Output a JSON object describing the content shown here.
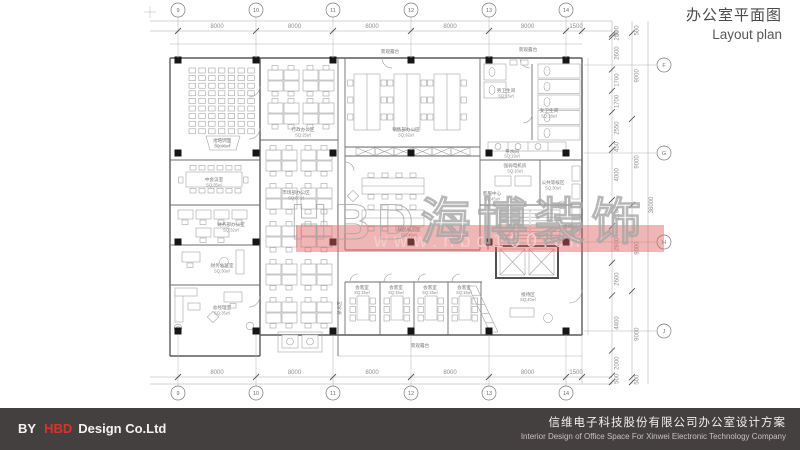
{
  "title": {
    "zh": "办公室平面图",
    "en": "Layout plan"
  },
  "footer": {
    "by": "BY",
    "brand": "HBD",
    "company": "Design Co.Ltd",
    "project_zh": "信维电子科技股份有限公司办公室设计方案",
    "project_en": "Interior Design of Office Space For Xinwei Electronic Technology Company"
  },
  "watermark": {
    "logo": "HBD海博装饰",
    "url": "www.hbd100.cn",
    "band_color": "#dd5e5e"
  },
  "dims": {
    "top": [
      "8000",
      "8000",
      "8000",
      "8000",
      "8000",
      "1500"
    ],
    "bottom": [
      "8000",
      "8000",
      "8000",
      "8000",
      "8000",
      "1500"
    ],
    "right_segments": [
      "500",
      "200",
      "2600",
      "1700",
      "1700",
      "2550",
      "450",
      "4000",
      "2100",
      "2900",
      "2600",
      "4400",
      "2000",
      "500"
    ],
    "right_spans": [
      "500",
      "9000",
      "9000",
      "9000",
      "9000",
      "500"
    ],
    "right_total": "36000"
  },
  "grid": {
    "cols": [
      "9",
      "10",
      "11",
      "12",
      "13",
      "14"
    ],
    "rows": [
      "F",
      "G",
      "H",
      "J"
    ]
  },
  "rooms": {
    "training": {
      "name": "大培训室",
      "area": "SQ:90㎡"
    },
    "meeting_mid": {
      "name": "中会议室",
      "area": "SQ:35㎡"
    },
    "finance": {
      "name": "财务部办公室",
      "area": "SQ:32㎡"
    },
    "finance_director": {
      "name": "财务总监室",
      "area": "SQ:30㎡"
    },
    "gm": {
      "name": "总经理室",
      "area": "SQ:35㎡"
    },
    "admin": {
      "name": "行政办公区",
      "area": "SQ:25㎡"
    },
    "market": {
      "name": "市场部办公区",
      "area": "SQ:88㎡"
    },
    "sales": {
      "name": "销售部办公区",
      "area": "SQ:92㎡"
    },
    "display": {
      "name": "样品展示室",
      "area": "SQ:40㎡"
    },
    "service": {
      "name": "客服中心",
      "area": "SQ:45㎡"
    },
    "wc_m": {
      "name": "男卫生间",
      "area": "SQ:15㎡"
    },
    "wc_f": {
      "name": "女卫生间",
      "area": "SQ:18㎡"
    },
    "pantry": {
      "name": "茶水间",
      "area": "SQ:19㎡"
    },
    "elec": {
      "name": "强弱电机房",
      "area": "SQ:10㎡"
    },
    "waiting": {
      "name": "公共等候区",
      "area": "SQ:30㎡"
    },
    "stair": {
      "name": "楼梯间"
    },
    "guest": {
      "name": "会客室",
      "area": "SQ:15㎡"
    },
    "reception": {
      "name": "接待区",
      "area": "SQ:40㎡"
    },
    "tea": {
      "name": "茶水区"
    },
    "terrace": {
      "name": "景观露台"
    }
  }
}
